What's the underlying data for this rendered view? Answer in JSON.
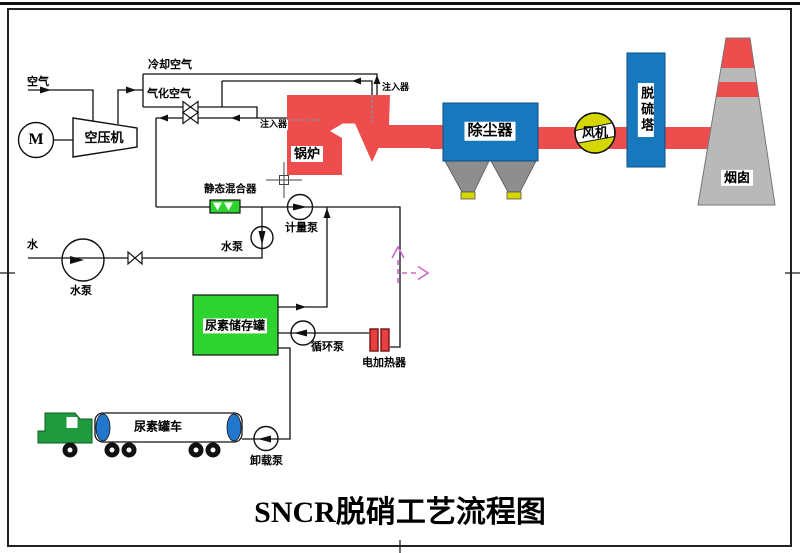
{
  "title": "SNCR脱硝工艺流程图",
  "labels": {
    "air": "空气",
    "cooling_air": "冷却空气",
    "gasification_air": "气化空气",
    "compressor": "空压机",
    "motor": "M",
    "injector_top": "注入器",
    "injector_side": "注入器",
    "boiler": "锅炉",
    "dust_collector": "除尘器",
    "fan": "风机",
    "desulfurization_tower": "脱硫塔",
    "chimney": "烟囱",
    "static_mixer": "静态混合器",
    "metering_pump": "计量泵",
    "booster_water_pump": "水泵",
    "water": "水",
    "water_pump": "水泵",
    "urea_storage_tank": "尿素储存罐",
    "circulation_pump": "循环泵",
    "electric_heater": "电加热器",
    "urea_truck": "尿素罐车",
    "unloading_pump": "卸载泵"
  },
  "colors": {
    "flue_red": "#ee4d4d",
    "equipment_blue": "#1878be",
    "tank_green": "#2fd32f",
    "hopper_gray": "#8e8e8e",
    "chimney_gray": "#b9b9b9",
    "tip_yellow": "#d6d600",
    "fan_yellow": "#d6d600",
    "heater_red": "#e84040",
    "truck_green": "#1f9a3f",
    "cap_blue": "#2277cc",
    "marker_magenta": "#cc66cc"
  }
}
